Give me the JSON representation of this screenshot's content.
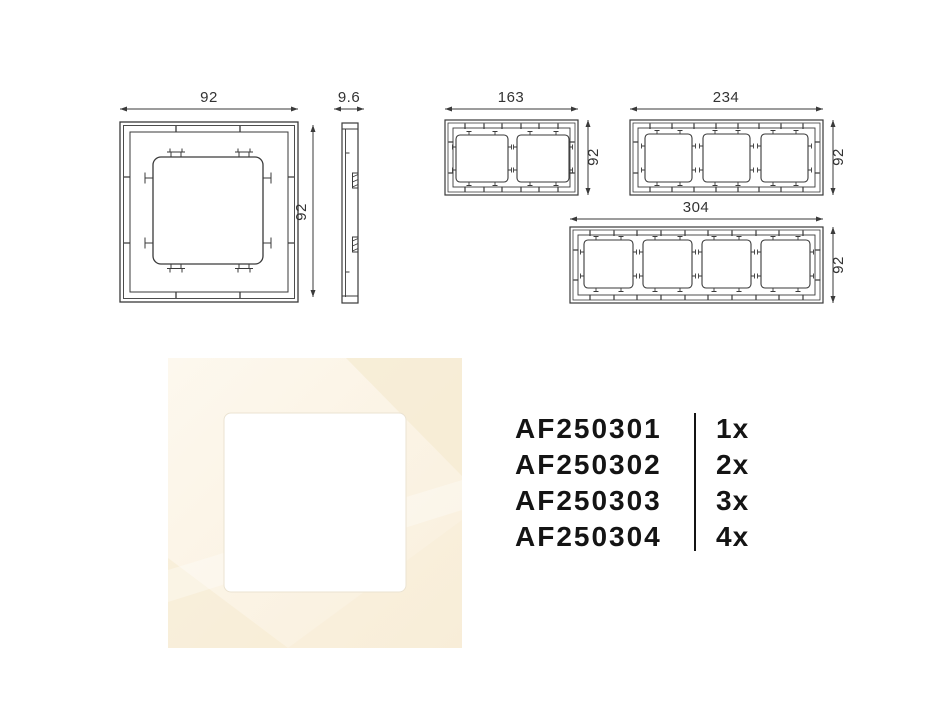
{
  "drawings": {
    "line_color": "#3a3a3a",
    "single_front": {
      "width_label": "92",
      "height_label": "92"
    },
    "side_profile": {
      "depth_label": "9.6"
    },
    "double_front": {
      "width_label": "163",
      "height_label": "92"
    },
    "triple_front": {
      "width_label": "234",
      "height_label": "92"
    },
    "quad_front": {
      "width_label": "304",
      "height_label": "92"
    }
  },
  "photo": {
    "frame_light": "#fdf8ee",
    "frame_base": "#f9efdc",
    "reflection_color": "#f6ebd2",
    "streak_color": "#ffffff",
    "opening_color": "#ffffff",
    "opening_edge": "#ebe3d2"
  },
  "parts_list": {
    "rows": [
      {
        "code": "AF250301",
        "quantity": "1x"
      },
      {
        "code": "AF250302",
        "quantity": "2x"
      },
      {
        "code": "AF250303",
        "quantity": "3x"
      },
      {
        "code": "AF250304",
        "quantity": "4x"
      }
    ]
  }
}
